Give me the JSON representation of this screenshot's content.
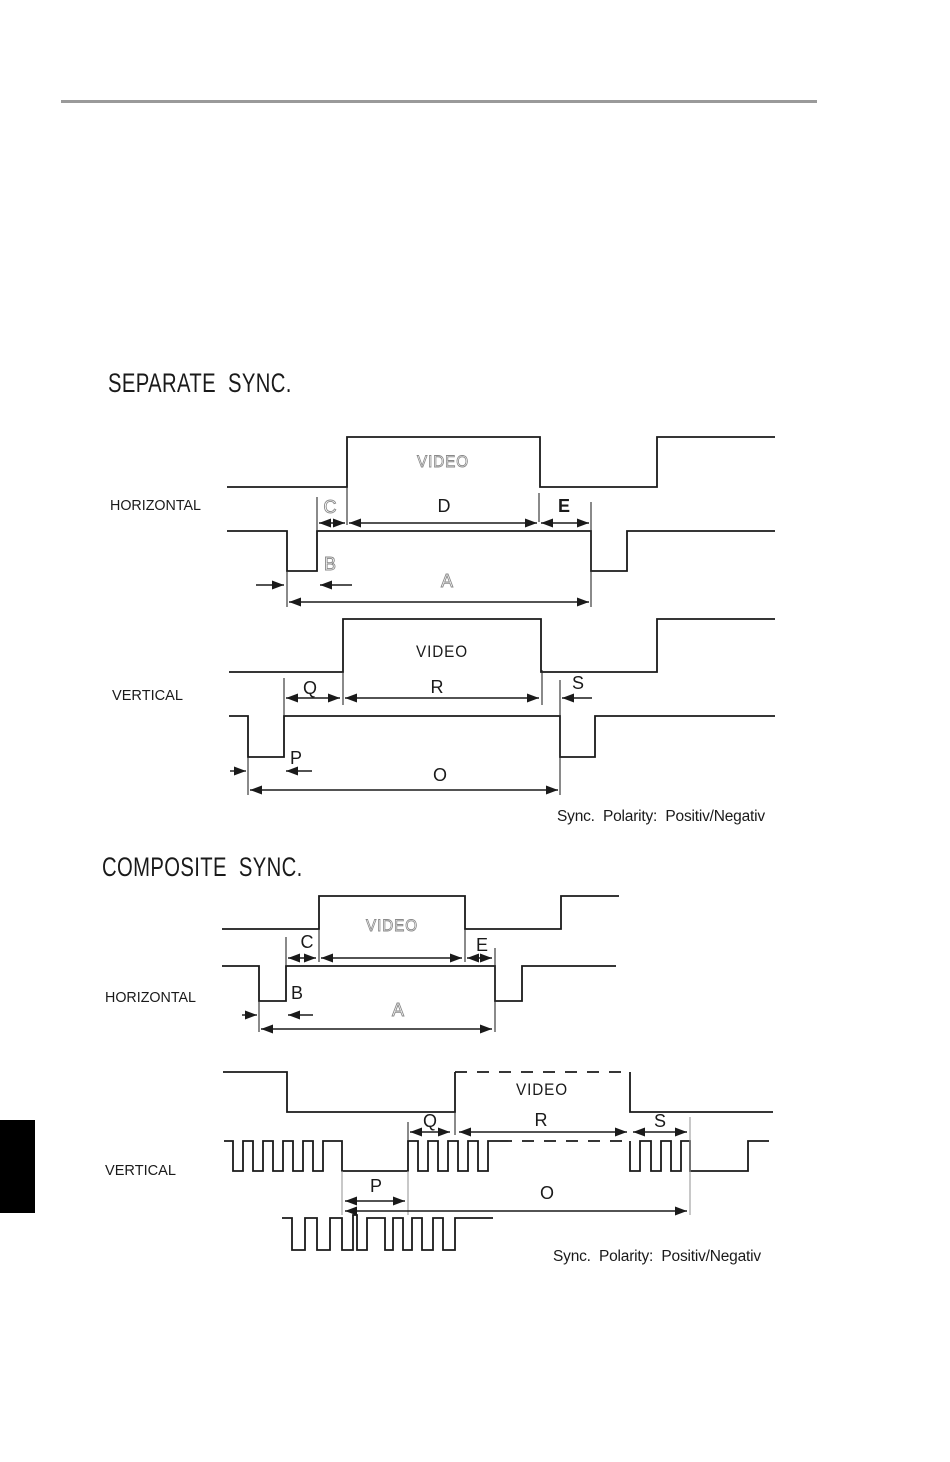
{
  "headings": {
    "separate": "SEPARATE  SYNC.",
    "composite": "COMPOSITE  SYNC."
  },
  "separate_sync": {
    "horizontal": {
      "axis": "HORIZONTAL",
      "video": "VIDEO",
      "dim_labels": {
        "A": "A",
        "B": "B",
        "C": "C",
        "D": "D",
        "E": "E"
      }
    },
    "vertical": {
      "axis": "VERTICAL",
      "video": "VIDEO",
      "dim_labels": {
        "O": "O",
        "P": "P",
        "Q": "Q",
        "R": "R",
        "S": "S"
      }
    },
    "polarity_note": "Sync.  Polarity:  Positiv/Negativ"
  },
  "composite_sync": {
    "horizontal": {
      "axis": "HORIZONTAL",
      "video": "VIDEO",
      "dim_labels": {
        "A": "A",
        "B": "B",
        "C": "C",
        "E": "E"
      }
    },
    "vertical": {
      "axis": "VERTICAL",
      "video": "VIDEO",
      "dim_labels": {
        "O": "O",
        "P": "P",
        "Q": "Q",
        "R": "R",
        "S": "S"
      }
    },
    "polarity_note": "Sync.  Polarity:  Positiv/Negativ"
  },
  "colors": {
    "line": "#1a1a1a",
    "rule": "#9a9a9a",
    "edge_marker": "#000000"
  }
}
